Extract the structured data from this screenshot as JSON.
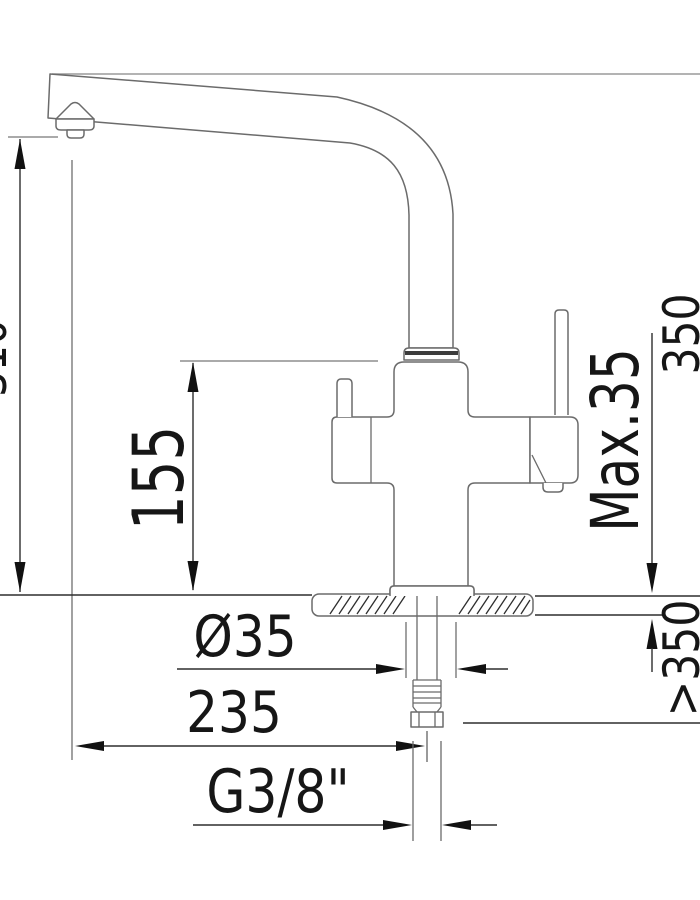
{
  "page": {
    "background": "#ffffff",
    "description": "Technical installation drawing of a three-way kitchen mixer tap, side elevation with dimensions in mm"
  },
  "drawing": {
    "type": "technical-dimension-drawing",
    "subject": "kitchen mixer tap with L-shaped swivel spout, side lever and under-counter supply hose",
    "line_color": "#6b6b6b",
    "dimension_color": "#2e2e2e",
    "labels": {
      "clipped_left_height": "310",
      "underspout_height": "155",
      "total_height": "350",
      "max_deck_thickness": "Max.35",
      "min_clearance_below": ">350",
      "hole_diameter": "Ø35",
      "spout_reach": "235",
      "thread_size": "G3/8\""
    }
  }
}
